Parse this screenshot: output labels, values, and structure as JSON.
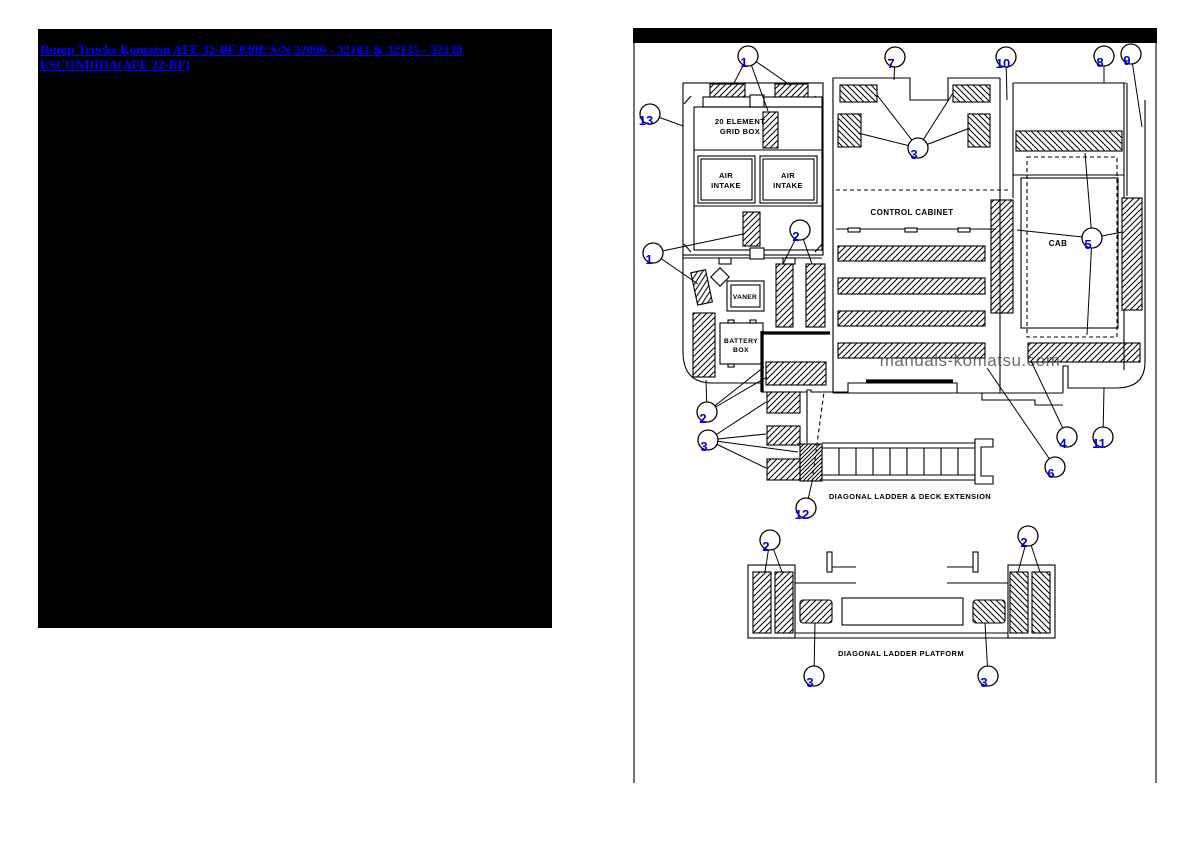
{
  "left_panel": {
    "link_text": "Dump Trucks Komatsu AFE 32-BF 830E S/N 32096 - 32102 & 32135 - 32139 ESCONDIDA(AFE 32-BF)",
    "link_color": "#0000ff",
    "background": "#000000"
  },
  "diagram": {
    "watermark": "manuals-komatsu.com",
    "callout_color": "#0000dd",
    "labels": {
      "grid_box_line1": "20 ELEMENT",
      "grid_box_line2": "GRID BOX",
      "air_line1": "AIR",
      "air_line2": "INTAKE",
      "vaner": "VANER",
      "battery_line1": "BATTERY",
      "battery_line2": "BOX",
      "control_cabinet": "CONTROL CABINET",
      "cab": "CAB",
      "caption_extension": "DIAGONAL LADDER & DECK EXTENSION",
      "caption_platform": "DIAGONAL LADDER PLATFORM"
    },
    "callouts": {
      "top": [
        "1",
        "7",
        "10",
        "8",
        "9",
        "13",
        "3",
        "1",
        "2",
        "5",
        "2",
        "3",
        "12",
        "4",
        "6",
        "11"
      ],
      "platform": [
        "2",
        "2",
        "3",
        "3"
      ]
    }
  }
}
